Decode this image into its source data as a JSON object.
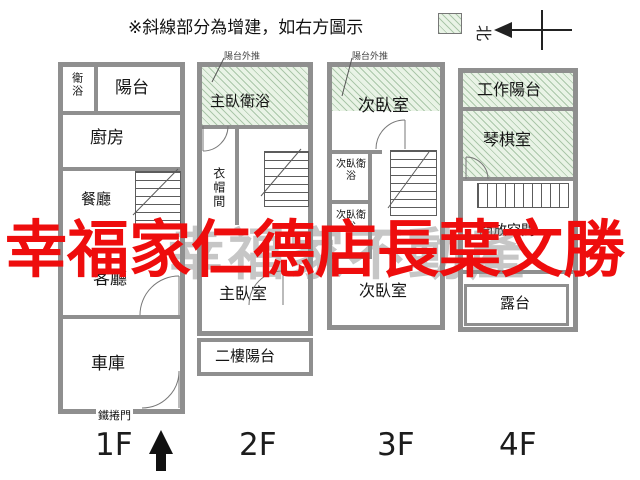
{
  "legend": {
    "text": "※斜線部分為增建，如右方圖示"
  },
  "compass": {
    "north": "北"
  },
  "watermarks": {
    "red_text": "幸福家仁德店長葉文勝",
    "gray_text": "幸福家不動產"
  },
  "floor1": {
    "label": "1F",
    "bathroom": "衛浴",
    "balcony": "陽台",
    "kitchen": "廚房",
    "dining": "餐廳",
    "living": "客廳",
    "garage": "車庫",
    "shutter_door": "鐵捲門"
  },
  "floor2": {
    "label": "2F",
    "annotation": "陽台外推",
    "master_bathroom": "主臥衛浴",
    "closet": "衣帽間",
    "master_bedroom": "主臥室",
    "balcony": "二樓陽台"
  },
  "floor3": {
    "label": "3F",
    "annotation": "陽台外推",
    "bedroom_upper": "次臥室",
    "bathroom_1": "次臥衛浴",
    "bathroom_2": "次臥衛浴",
    "bedroom_lower": "次臥室"
  },
  "floor4": {
    "label": "4F",
    "work_balcony": "工作陽台",
    "piano_room": "琴棋室",
    "open_space": "開放空間",
    "terrace": "露台"
  },
  "colors": {
    "watermark_red": "#ee0d0d",
    "hatch_green": "#e9f3e6",
    "wall_gray": "#8f8f8f"
  }
}
